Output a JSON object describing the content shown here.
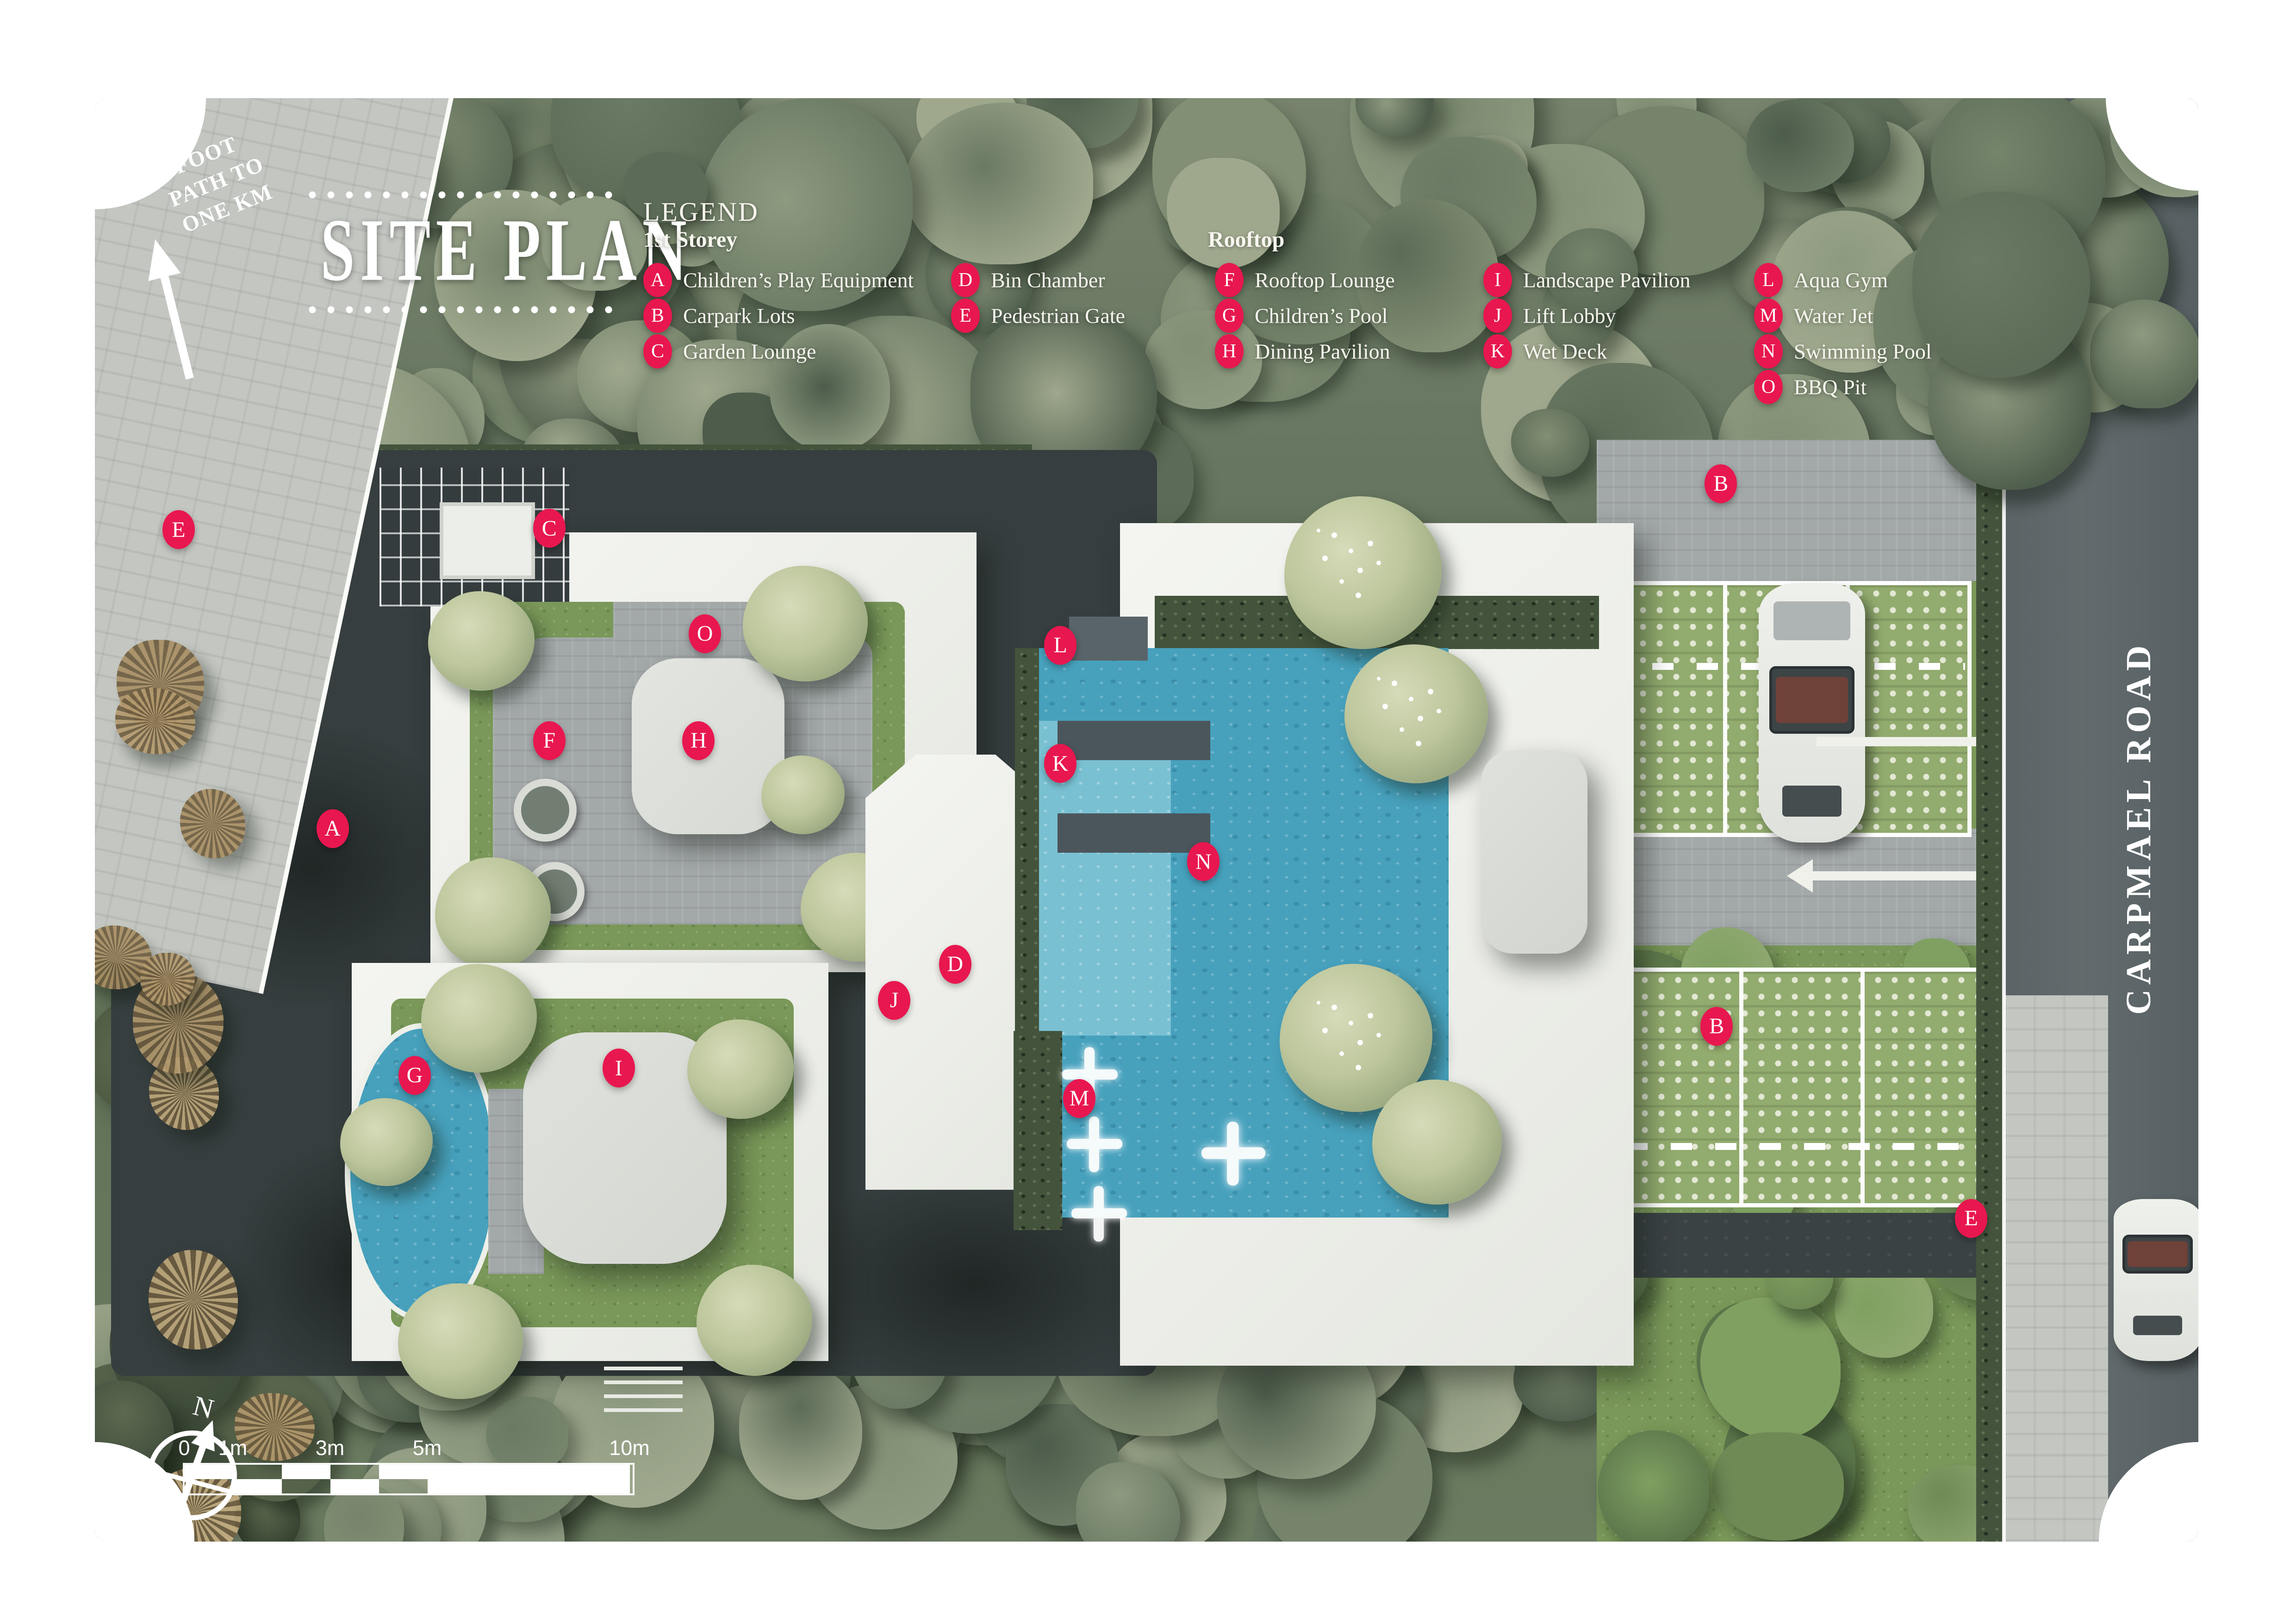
{
  "title": "SITE PLAN",
  "legend": {
    "heading": "LEGEND",
    "groups": [
      {
        "name": "1st Storey",
        "columns": [
          [
            {
              "letter": "A",
              "label": "Children’s Play Equipment"
            },
            {
              "letter": "B",
              "label": "Carpark Lots"
            },
            {
              "letter": "C",
              "label": "Garden Lounge"
            }
          ],
          [
            {
              "letter": "D",
              "label": "Bin Chamber"
            },
            {
              "letter": "E",
              "label": "Pedestrian Gate"
            }
          ]
        ]
      },
      {
        "name": "Rooftop",
        "columns": [
          [
            {
              "letter": "F",
              "label": "Rooftop Lounge"
            },
            {
              "letter": "G",
              "label": "Children’s Pool"
            },
            {
              "letter": "H",
              "label": "Dining Pavilion"
            }
          ],
          [
            {
              "letter": "I",
              "label": "Landscape Pavilion"
            },
            {
              "letter": "J",
              "label": "Lift Lobby"
            },
            {
              "letter": "K",
              "label": "Wet Deck"
            }
          ],
          [
            {
              "letter": "L",
              "label": "Aqua Gym"
            },
            {
              "letter": "M",
              "label": "Water Jet"
            },
            {
              "letter": "N",
              "label": "Swimming Pool"
            },
            {
              "letter": "O",
              "label": "BBQ Pit"
            }
          ]
        ]
      }
    ]
  },
  "map": {
    "road_label": "CARPMAEL ROAD",
    "footpath_label": "FOOT\nPATH TO\nONE KM",
    "compass_label": "N",
    "markers": [
      {
        "letter": "E",
        "x": 3.98,
        "y": 29.9
      },
      {
        "letter": "C",
        "x": 21.6,
        "y": 29.8
      },
      {
        "letter": "O",
        "x": 29.0,
        "y": 37.1
      },
      {
        "letter": "F",
        "x": 21.6,
        "y": 44.5
      },
      {
        "letter": "H",
        "x": 28.7,
        "y": 44.5
      },
      {
        "letter": "A",
        "x": 11.3,
        "y": 50.6
      },
      {
        "letter": "G",
        "x": 15.2,
        "y": 67.7
      },
      {
        "letter": "I",
        "x": 24.9,
        "y": 67.2
      },
      {
        "letter": "D",
        "x": 40.9,
        "y": 60.0
      },
      {
        "letter": "J",
        "x": 38.0,
        "y": 62.5
      },
      {
        "letter": "L",
        "x": 45.9,
        "y": 37.9
      },
      {
        "letter": "K",
        "x": 45.9,
        "y": 46.1
      },
      {
        "letter": "N",
        "x": 52.7,
        "y": 52.9
      },
      {
        "letter": "M",
        "x": 46.8,
        "y": 69.3
      },
      {
        "letter": "B",
        "x": 77.3,
        "y": 26.7
      },
      {
        "letter": "B",
        "x": 77.1,
        "y": 64.3
      },
      {
        "letter": "E",
        "x": 89.2,
        "y": 77.6
      }
    ]
  },
  "scale_bar": {
    "labels": [
      "0",
      "1m",
      "3m",
      "5m",
      "10m"
    ]
  },
  "colors": {
    "marker_pink": "#E8174F",
    "pool_blue": "#47A1BD",
    "road_gray": "#5E6769"
  }
}
